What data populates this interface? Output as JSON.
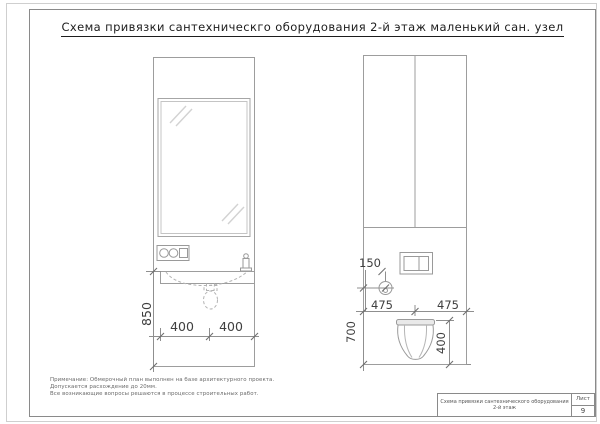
{
  "sheet": {
    "title": "Схема привязки сантехническго оборудования 2-й этаж маленький сан. узел"
  },
  "left_view": {
    "dim_height_850": "850",
    "dim_width_left_400": "400",
    "dim_width_right_400": "400"
  },
  "right_view": {
    "dim_water_offset_150": "150",
    "dim_width_left_475": "475",
    "dim_width_right_475": "475",
    "dim_height_700": "700",
    "dim_bowl_height_400": "400"
  },
  "notes": {
    "line1": "Примечание: Обмерочный план выполнен на базе архитектурного проекта.",
    "line2": "Допускается расхождение до 20мм.",
    "line3": "Все возникающие вопросы решаются в процессе строительных работ."
  },
  "title_block": {
    "document_title": "Схема привязки сантехнического оборудования 2-й этаж",
    "sheet_label": "Лист",
    "sheet_number": "9"
  },
  "colors": {
    "object_line": "#9d9d9d",
    "dimension_line": "#7d7d7d",
    "dimension_text": "#3f3f3f"
  }
}
